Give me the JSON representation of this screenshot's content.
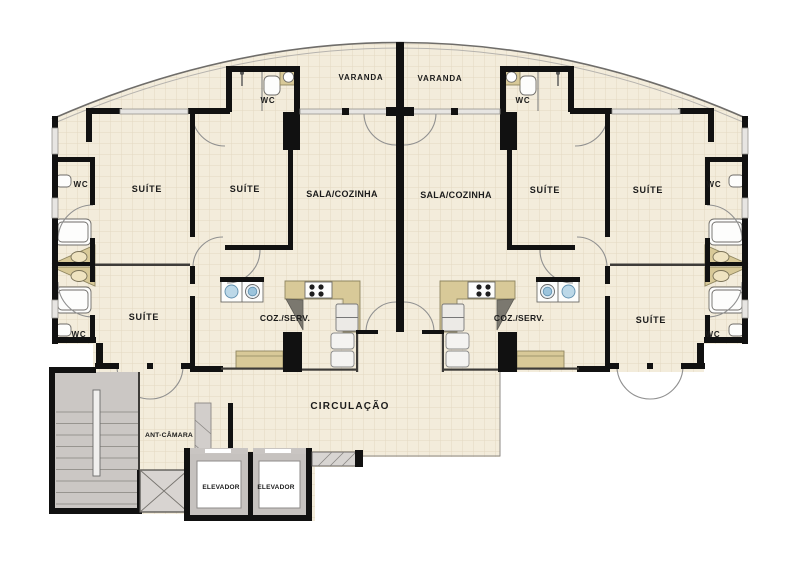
{
  "plan": {
    "type": "residential-floor-plan",
    "units": 2,
    "rooms": {
      "varanda": "VARANDA",
      "wc": "WC",
      "suite": "SUÍTE",
      "sala_cozinha": "SALA/COZINHA",
      "coz_serv": "COZ./SERV.",
      "circulacao": "CIRCULAÇÃO",
      "ant_camara": "ANT-CÂMARA",
      "elevador": "ELEVADOR"
    },
    "colors": {
      "floor": "#f3ecdb",
      "tile_line": "#e3d8c1",
      "wall": "#111111",
      "counter_tan": "#d8c998",
      "stair_grey": "#cbc7c4",
      "laundry_blue": "#9cc4dc",
      "label_text": "#1b1b1b"
    }
  }
}
